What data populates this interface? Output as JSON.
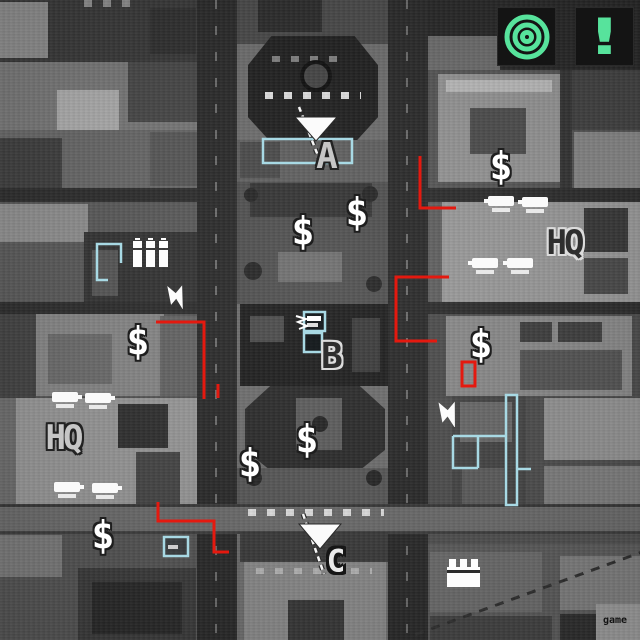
{
  "watermark": "game",
  "markers": {
    "capture_points": [
      {
        "id": "A",
        "label": "A",
        "style": "light-letter"
      },
      {
        "id": "B",
        "label": "B",
        "style": "dark-letter"
      },
      {
        "id": "C",
        "label": "C",
        "style": "heavy-outline-letter"
      }
    ],
    "hq": [
      {
        "label": "HQ",
        "side": "right",
        "style": "dark-letter"
      },
      {
        "label": "HQ",
        "side": "left",
        "style": "light-letter"
      }
    ],
    "money_symbol": "$",
    "money_point_count": 8,
    "alert_symbol": "!",
    "tank_unit_count": 8
  },
  "icons": {
    "objective": "bullseye-target-icon",
    "alert": "exclamation-icon",
    "money": "dollar-sign-icon",
    "unit": "tank-silhouette-icon",
    "lightning": "lightning-bolt-icon",
    "city_building": "city-building-icon",
    "factory": "factory-icon",
    "capture_flag": "down-triangle-flag-icon"
  },
  "colors": {
    "objective_green": "#57e39c",
    "route_red": "#e4190f",
    "selection_cyan": "#a8d9e4",
    "map_style": "grayscale-aerial"
  }
}
